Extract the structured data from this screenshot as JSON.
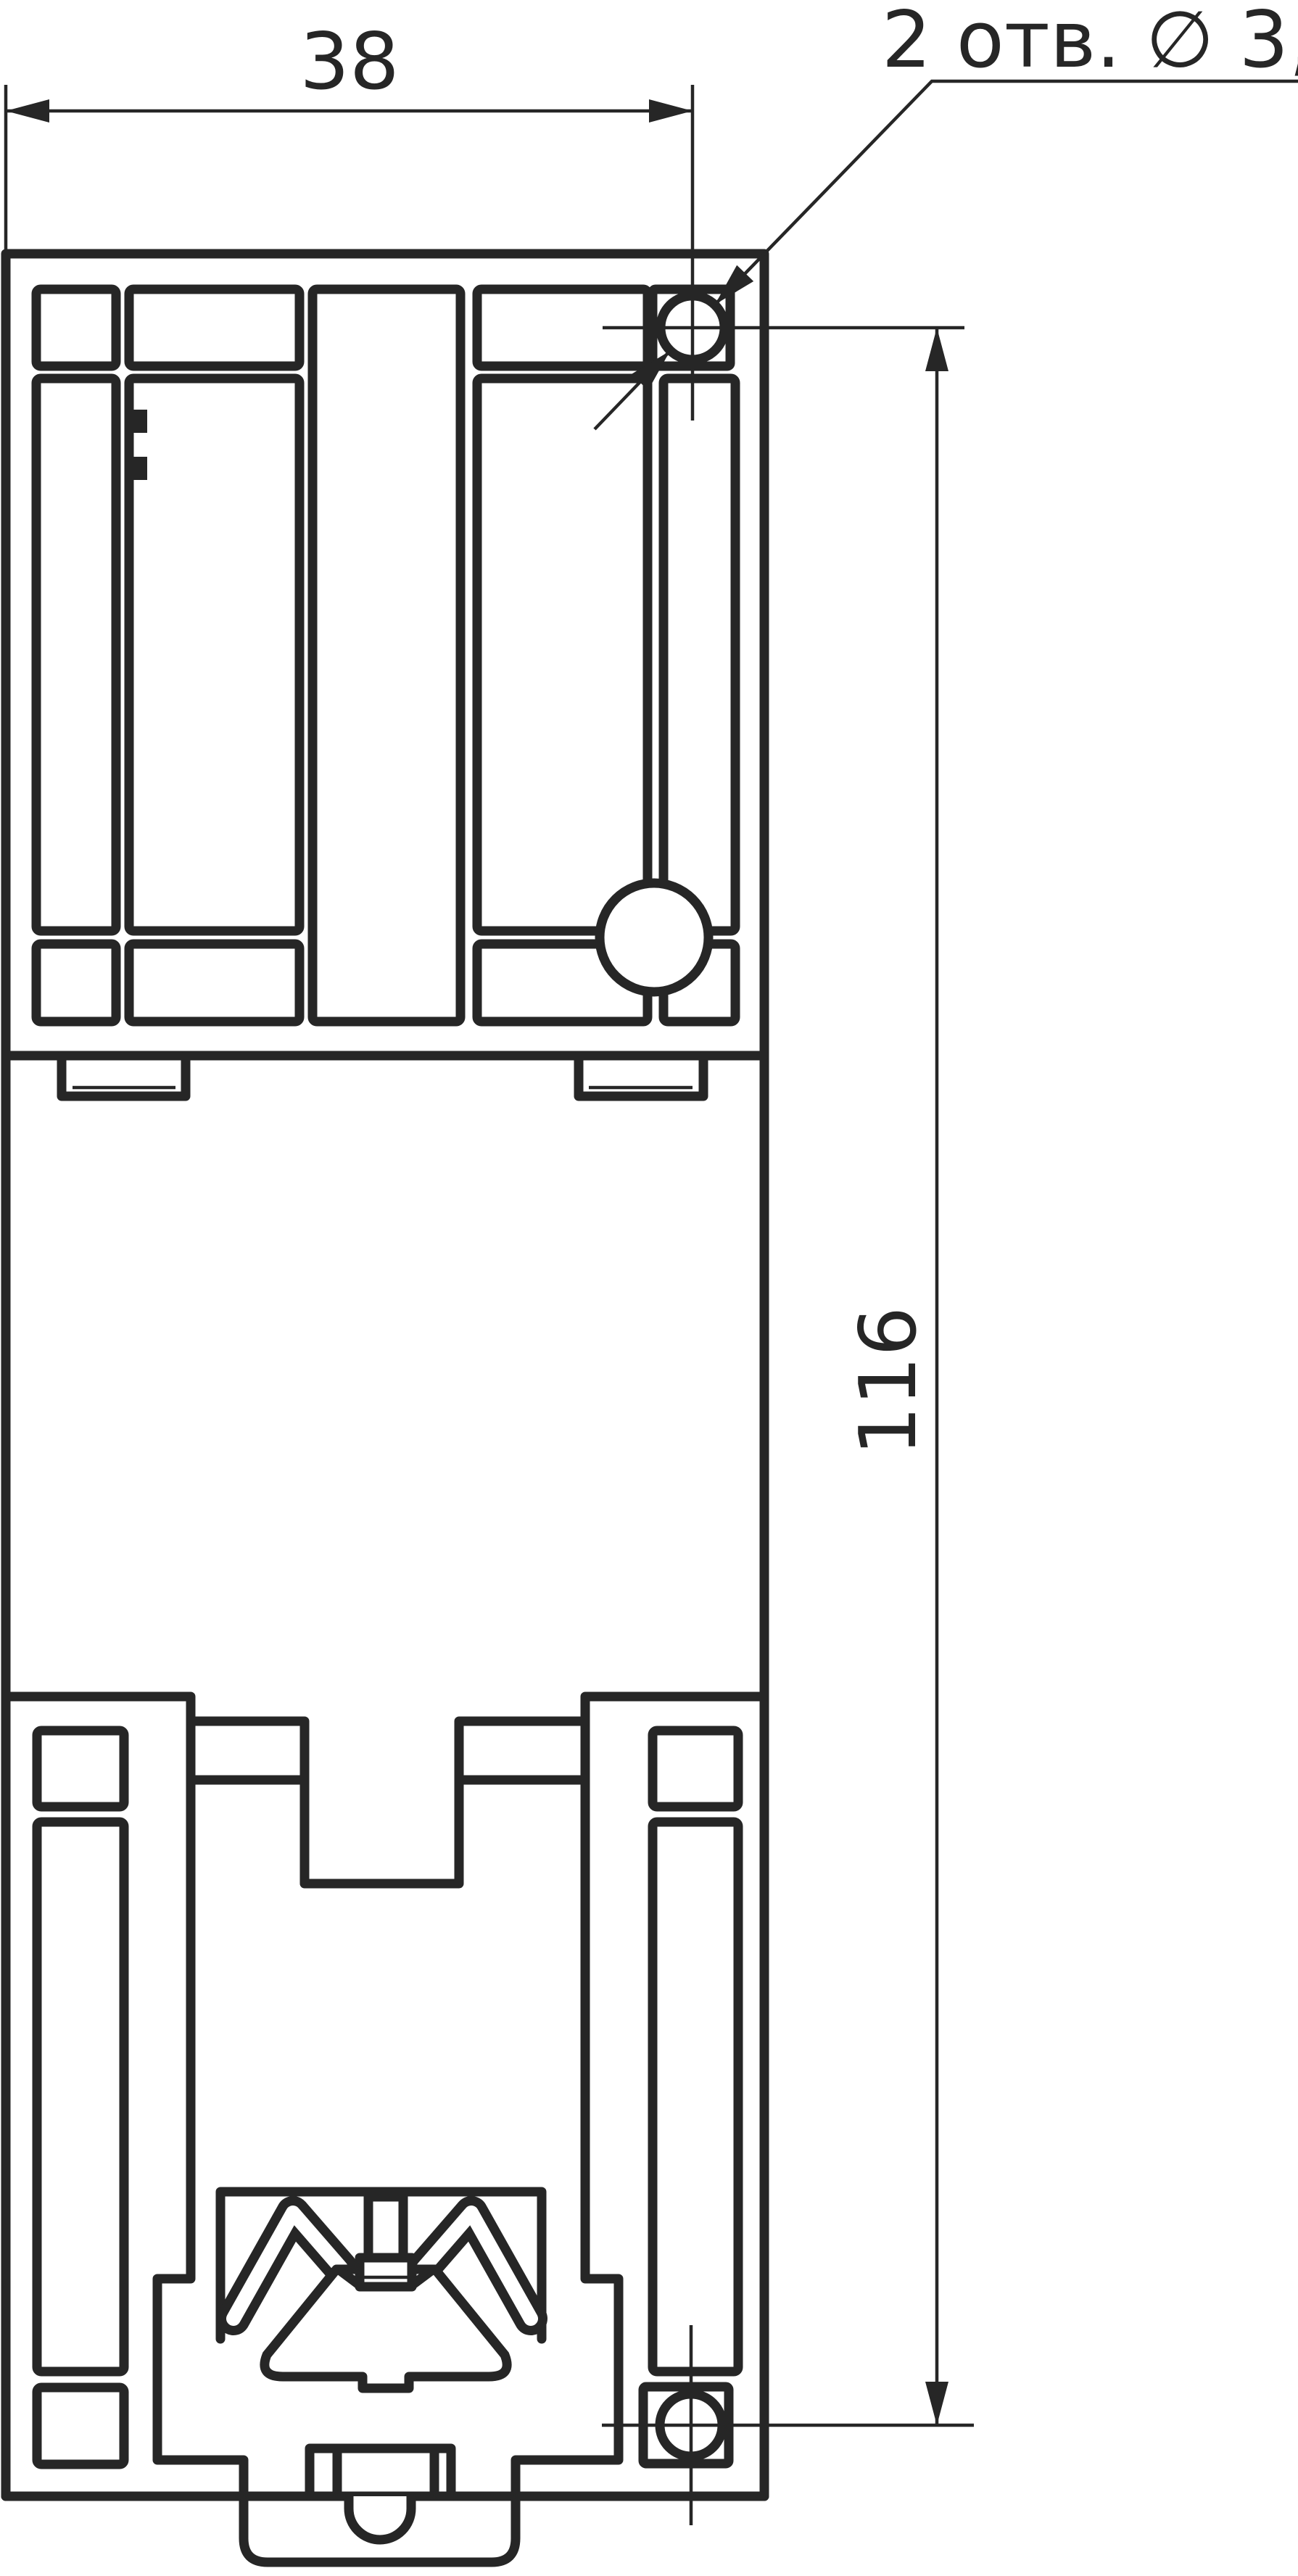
{
  "drawing": {
    "kind": "technical-dimension-drawing",
    "labels": {
      "width_dim": "38",
      "height_dim": "116",
      "holes_note": "2 отв. ∅ 3,5"
    },
    "colors": {
      "line": "#262626",
      "background": "#ffffff"
    }
  }
}
